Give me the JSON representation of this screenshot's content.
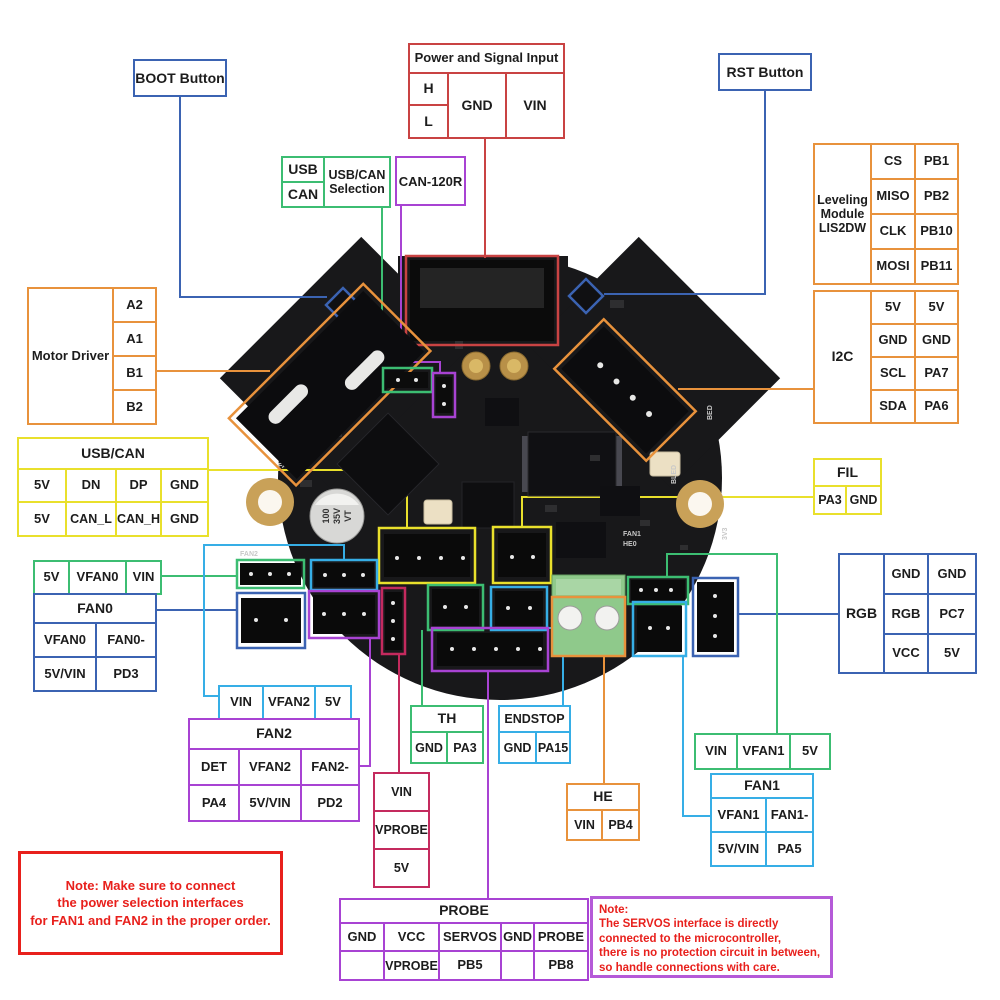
{
  "colors": {
    "blue": "#3b63b2",
    "red": "#c94343",
    "green": "#3cbd72",
    "yellow": "#e9e02c",
    "orange": "#e8923c",
    "purple": "#a843d3",
    "cyan": "#36aee6",
    "crimson": "#c42a5e",
    "magenta": "#b55ad8",
    "note_red": "#e8201c",
    "ink": "#1c1c1c"
  },
  "buttons": {
    "boot": "BOOT Button",
    "rst": "RST Button",
    "can_120r": "CAN-120R"
  },
  "power_input": {
    "title": "Power and Signal Input",
    "h": "H",
    "l": "L",
    "gnd": "GND",
    "vin": "VIN"
  },
  "usb_can_selection": {
    "usb": "USB",
    "can": "CAN",
    "label": "USB/CAN\nSelection"
  },
  "leveling_module": {
    "label": "Leveling\nModule\nLIS2DW",
    "rows": [
      [
        "CS",
        "PB1"
      ],
      [
        "MISO",
        "PB2"
      ],
      [
        "CLK",
        "PB10"
      ],
      [
        "MOSI",
        "PB11"
      ]
    ]
  },
  "i2c": {
    "label": "I2C",
    "rows": [
      [
        "5V",
        "5V"
      ],
      [
        "GND",
        "GND"
      ],
      [
        "SCL",
        "PA7"
      ],
      [
        "SDA",
        "PA6"
      ]
    ]
  },
  "motor_driver": {
    "label": "Motor Driver",
    "pins": [
      "A2",
      "A1",
      "B1",
      "B2"
    ]
  },
  "usb_can": {
    "title": "USB/CAN",
    "rows": [
      [
        "5V",
        "DN",
        "DP",
        "GND"
      ],
      [
        "5V",
        "CAN_L",
        "CAN_H",
        "GND"
      ]
    ]
  },
  "fil": {
    "title": "FIL",
    "pins": [
      "PA3",
      "GND"
    ]
  },
  "fan0_power_select": {
    "pins": [
      "5V",
      "VFAN0",
      "VIN"
    ]
  },
  "fan0": {
    "title": "FAN0",
    "rows": [
      [
        "VFAN0",
        "FAN0-"
      ],
      [
        "5V/VIN",
        "PD3"
      ]
    ]
  },
  "rgb": {
    "label": "RGB",
    "rows": [
      [
        "GND",
        "GND"
      ],
      [
        "RGB",
        "PC7"
      ],
      [
        "VCC",
        "5V"
      ]
    ]
  },
  "fan2_power_select": {
    "pins": [
      "VIN",
      "VFAN2",
      "5V"
    ]
  },
  "fan2": {
    "title": "FAN2",
    "rows": [
      [
        "DET",
        "VFAN2",
        "FAN2-"
      ],
      [
        "PA4",
        "5V/VIN",
        "PD2"
      ]
    ]
  },
  "th": {
    "title": "TH",
    "pins": [
      "GND",
      "PA3"
    ]
  },
  "endstop": {
    "title": "ENDSTOP",
    "pins": [
      "GND",
      "PA15"
    ]
  },
  "probe_power_select": {
    "pins": [
      "VIN",
      "VPROBE",
      "5V"
    ]
  },
  "he": {
    "title": "HE",
    "pins": [
      "VIN",
      "PB4"
    ]
  },
  "fan1_power_select": {
    "pins": [
      "VIN",
      "VFAN1",
      "5V"
    ]
  },
  "fan1": {
    "title": "FAN1",
    "rows": [
      [
        "VFAN1",
        "FAN1-"
      ],
      [
        "5V/VIN",
        "PA5"
      ]
    ]
  },
  "probe": {
    "title": "PROBE",
    "rows": [
      [
        "GND",
        "VCC",
        "SERVOS",
        "GND",
        "PROBE"
      ],
      [
        "",
        "VPROBE",
        "PB5",
        "",
        "PB8"
      ]
    ]
  },
  "note_fan": "Note: Make sure to connect\nthe power selection interfaces\nfor FAN1 and FAN2 in the proper order.",
  "note_servos": "Note:\nThe SERVOS interface is directly\nconnected to the microcontroller,\nthere is no protection circuit in between,\nso handle connections with care.",
  "board": {
    "capacitor": [
      "100",
      "35V",
      "VT"
    ],
    "silkscreen": {
      "fan0": "FAN0",
      "fan2": "FAN2",
      "fan1": "FAN1",
      "he0": "HE0",
      "bled": "BLED",
      "bed": "BED",
      "v33": "3V3"
    }
  }
}
